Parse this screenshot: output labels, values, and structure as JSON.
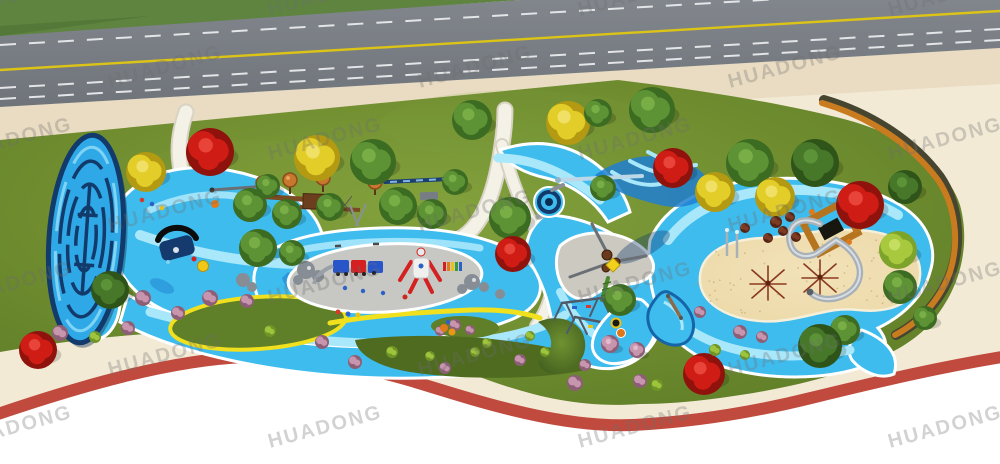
{
  "scene": {
    "label": "HUADONG outdoor playground park - aerial plan rendering",
    "width": 1000,
    "height": 464
  },
  "watermark": {
    "text": "HUADONG",
    "color": "#6e6e6e",
    "opacity": 0.3,
    "rotation_deg": -15,
    "font_size": 20,
    "tile_dx": 310,
    "tile_dy": 72,
    "row_offset_x": 150,
    "start_x": -40,
    "start_y": 16,
    "rows": 7,
    "cols": 4
  },
  "palette": {
    "grass_verge": "#5e8440",
    "grass_verge_dark": "#4c7032",
    "road": "#7b8086",
    "road_dark": "#6f747a",
    "lane_white": "#e3e5e7",
    "lane_yellow": "#dcc416",
    "sidewalk": "#e9dcc2",
    "plaza": "#f3ead6",
    "walkway": "#f3e9d4",
    "track": "#c04a3d",
    "lawn": "#6f8c2f",
    "lawn_light": "#83a23d",
    "lawn_dark": "#5d7d27",
    "island": "#5f7f28",
    "island_dark": "#4e6b20",
    "water": "#3fbcee",
    "water_light": "#a9e7fb",
    "water_deep": "#1e7fd0",
    "navy": "#123a6b",
    "path_white": "#f4f1e7",
    "path_edge": "#d8d3c4",
    "plaza_gray": "#c7c8c3",
    "rock": "#868d94",
    "sand": "#ecd9a9",
    "sand_speck": "#c09a5e",
    "wood": "#c97b20",
    "wood_dark": "#46452f",
    "yellow_stripe": "#f0e01e",
    "steel": "#a8b0b8",
    "steel_light": "#d9dee3",
    "brown": "#7a4a22",
    "shadow": "rgba(20,60,110,0.38)"
  },
  "tree_colors": {
    "green": {
      "dark": "#3c6b22",
      "main": "#5d9334",
      "light": "#79ad46"
    },
    "darkgreen": {
      "dark": "#2e5419",
      "main": "#47782a",
      "light": "#5d9338"
    },
    "lime": {
      "dark": "#7da32a",
      "main": "#a8c93e",
      "light": "#c4de62"
    },
    "red": {
      "dark": "#8f130c",
      "main": "#cf1d15",
      "light": "#e8443a"
    },
    "yellow": {
      "dark": "#b39a12",
      "main": "#e3cd28",
      "light": "#f0e065"
    },
    "pink": {
      "dark": "#8d5f77",
      "main": "#c795ad",
      "light": "#e3b9cd"
    }
  },
  "bush_colors": {
    "p": {
      "dark": "#8d5f77",
      "main": "#c795ad"
    },
    "l": {
      "dark": "#6f9427",
      "main": "#9ec43d"
    },
    "s": {
      "dark": "#552412",
      "main": "#7e3a22"
    }
  },
  "trees": [
    {
      "x": 146,
      "y": 172,
      "r": 20,
      "t": "yellow"
    },
    {
      "x": 210,
      "y": 152,
      "r": 24,
      "t": "red"
    },
    {
      "x": 317,
      "y": 158,
      "r": 23,
      "t": "yellow"
    },
    {
      "x": 373,
      "y": 162,
      "r": 23,
      "t": "green"
    },
    {
      "x": 472,
      "y": 120,
      "r": 20,
      "t": "green"
    },
    {
      "x": 568,
      "y": 123,
      "r": 22,
      "t": "yellow"
    },
    {
      "x": 598,
      "y": 113,
      "r": 14,
      "t": "green"
    },
    {
      "x": 652,
      "y": 110,
      "r": 23,
      "t": "green"
    },
    {
      "x": 750,
      "y": 163,
      "r": 24,
      "t": "green"
    },
    {
      "x": 673,
      "y": 168,
      "r": 20,
      "t": "red"
    },
    {
      "x": 815,
      "y": 163,
      "r": 24,
      "t": "darkgreen"
    },
    {
      "x": 860,
      "y": 205,
      "r": 24,
      "t": "red"
    },
    {
      "x": 775,
      "y": 197,
      "r": 20,
      "t": "yellow"
    },
    {
      "x": 715,
      "y": 192,
      "r": 20,
      "t": "yellow"
    },
    {
      "x": 250,
      "y": 205,
      "r": 17,
      "t": "green"
    },
    {
      "x": 287,
      "y": 214,
      "r": 15,
      "t": "green"
    },
    {
      "x": 330,
      "y": 207,
      "r": 14,
      "t": "green"
    },
    {
      "x": 398,
      "y": 206,
      "r": 19,
      "t": "green"
    },
    {
      "x": 432,
      "y": 214,
      "r": 15,
      "t": "green"
    },
    {
      "x": 268,
      "y": 186,
      "r": 12,
      "t": "green"
    },
    {
      "x": 455,
      "y": 182,
      "r": 13,
      "t": "green"
    },
    {
      "x": 510,
      "y": 218,
      "r": 21,
      "t": "green"
    },
    {
      "x": 513,
      "y": 254,
      "r": 18,
      "t": "red"
    },
    {
      "x": 603,
      "y": 188,
      "r": 13,
      "t": "green"
    },
    {
      "x": 620,
      "y": 300,
      "r": 16,
      "t": "green"
    },
    {
      "x": 110,
      "y": 290,
      "r": 19,
      "t": "darkgreen"
    },
    {
      "x": 258,
      "y": 248,
      "r": 19,
      "t": "green"
    },
    {
      "x": 292,
      "y": 253,
      "r": 13,
      "t": "green"
    },
    {
      "x": 898,
      "y": 250,
      "r": 19,
      "t": "lime"
    },
    {
      "x": 900,
      "y": 287,
      "r": 17,
      "t": "green"
    },
    {
      "x": 905,
      "y": 187,
      "r": 17,
      "t": "darkgreen"
    },
    {
      "x": 845,
      "y": 330,
      "r": 15,
      "t": "green"
    },
    {
      "x": 925,
      "y": 318,
      "r": 12,
      "t": "green"
    },
    {
      "x": 820,
      "y": 346,
      "r": 22,
      "t": "darkgreen"
    },
    {
      "x": 704,
      "y": 374,
      "r": 21,
      "t": "red"
    },
    {
      "x": 38,
      "y": 350,
      "r": 19,
      "t": "red"
    },
    {
      "x": 610,
      "y": 344,
      "r": 9,
      "t": "pink"
    },
    {
      "x": 637,
      "y": 350,
      "r": 8,
      "t": "pink"
    }
  ],
  "bushes": [
    {
      "x": 143,
      "y": 298,
      "r": 8,
      "t": "p"
    },
    {
      "x": 210,
      "y": 298,
      "r": 8,
      "t": "p"
    },
    {
      "x": 247,
      "y": 301,
      "r": 7,
      "t": "p"
    },
    {
      "x": 178,
      "y": 313,
      "r": 7,
      "t": "p"
    },
    {
      "x": 128,
      "y": 328,
      "r": 7,
      "t": "p"
    },
    {
      "x": 60,
      "y": 333,
      "r": 8,
      "t": "p"
    },
    {
      "x": 575,
      "y": 383,
      "r": 8,
      "t": "p"
    },
    {
      "x": 640,
      "y": 381,
      "r": 7,
      "t": "p"
    },
    {
      "x": 322,
      "y": 342,
      "r": 7,
      "t": "p"
    },
    {
      "x": 740,
      "y": 332,
      "r": 7,
      "t": "p"
    },
    {
      "x": 762,
      "y": 337,
      "r": 6,
      "t": "p"
    },
    {
      "x": 700,
      "y": 312,
      "r": 6,
      "t": "p"
    },
    {
      "x": 455,
      "y": 325,
      "r": 6,
      "t": "p"
    },
    {
      "x": 440,
      "y": 331,
      "r": 5,
      "t": "p"
    },
    {
      "x": 470,
      "y": 330,
      "r": 5,
      "t": "p"
    },
    {
      "x": 355,
      "y": 362,
      "r": 7,
      "t": "p"
    },
    {
      "x": 445,
      "y": 368,
      "r": 6,
      "t": "p"
    },
    {
      "x": 520,
      "y": 360,
      "r": 6,
      "t": "p"
    },
    {
      "x": 585,
      "y": 365,
      "r": 6,
      "t": "p"
    },
    {
      "x": 270,
      "y": 331,
      "r": 6,
      "t": "l"
    },
    {
      "x": 392,
      "y": 352,
      "r": 6,
      "t": "l"
    },
    {
      "x": 430,
      "y": 356,
      "r": 5,
      "t": "l"
    },
    {
      "x": 475,
      "y": 352,
      "r": 5,
      "t": "l"
    },
    {
      "x": 545,
      "y": 352,
      "r": 5,
      "t": "l"
    },
    {
      "x": 487,
      "y": 343,
      "r": 5,
      "t": "l"
    },
    {
      "x": 530,
      "y": 336,
      "r": 5,
      "t": "l"
    },
    {
      "x": 657,
      "y": 385,
      "r": 6,
      "t": "l"
    },
    {
      "x": 95,
      "y": 337,
      "r": 6,
      "t": "l"
    },
    {
      "x": 715,
      "y": 350,
      "r": 6,
      "t": "l"
    },
    {
      "x": 745,
      "y": 355,
      "r": 5,
      "t": "l"
    },
    {
      "x": 776,
      "y": 222,
      "r": 6,
      "t": "s"
    },
    {
      "x": 790,
      "y": 217,
      "r": 5,
      "t": "s"
    },
    {
      "x": 783,
      "y": 231,
      "r": 5,
      "t": "s"
    },
    {
      "x": 768,
      "y": 238,
      "r": 5,
      "t": "s"
    },
    {
      "x": 796,
      "y": 237,
      "r": 5,
      "t": "s"
    },
    {
      "x": 745,
      "y": 228,
      "r": 5,
      "t": "s"
    }
  ],
  "markers": [
    {
      "x": 338,
      "y": 312,
      "r": 2.5,
      "c": "#d43b2a"
    },
    {
      "x": 348,
      "y": 314,
      "r": 2.5,
      "c": "#2b62c8"
    },
    {
      "x": 358,
      "y": 315,
      "r": 2.5,
      "c": "#e8c21a"
    },
    {
      "x": 345,
      "y": 288,
      "r": 2.2,
      "c": "#2b62c8"
    },
    {
      "x": 363,
      "y": 291,
      "r": 2.2,
      "c": "#2b62c8"
    },
    {
      "x": 383,
      "y": 293,
      "r": 2.2,
      "c": "#2b62c8"
    },
    {
      "x": 405,
      "y": 297,
      "r": 2.5,
      "c": "#c8281e"
    },
    {
      "x": 448,
      "y": 322,
      "r": 2.2,
      "c": "#2b62c8"
    },
    {
      "x": 142,
      "y": 200,
      "r": 2.3,
      "c": "#d43b2a"
    },
    {
      "x": 152,
      "y": 204,
      "r": 2.3,
      "c": "#2b62c8"
    },
    {
      "x": 162,
      "y": 208,
      "r": 2.3,
      "c": "#e8c21a"
    },
    {
      "x": 444,
      "y": 328,
      "r": 4,
      "c": "#e07a1a"
    },
    {
      "x": 452,
      "y": 332,
      "r": 3.5,
      "c": "#e8971a"
    },
    {
      "x": 215,
      "y": 204,
      "r": 4,
      "c": "#e07a1a"
    }
  ],
  "benches": [
    {
      "x": 300,
      "y": 251,
      "a": -6
    },
    {
      "x": 338,
      "y": 246,
      "a": -3
    },
    {
      "x": 376,
      "y": 244,
      "a": -1
    }
  ]
}
